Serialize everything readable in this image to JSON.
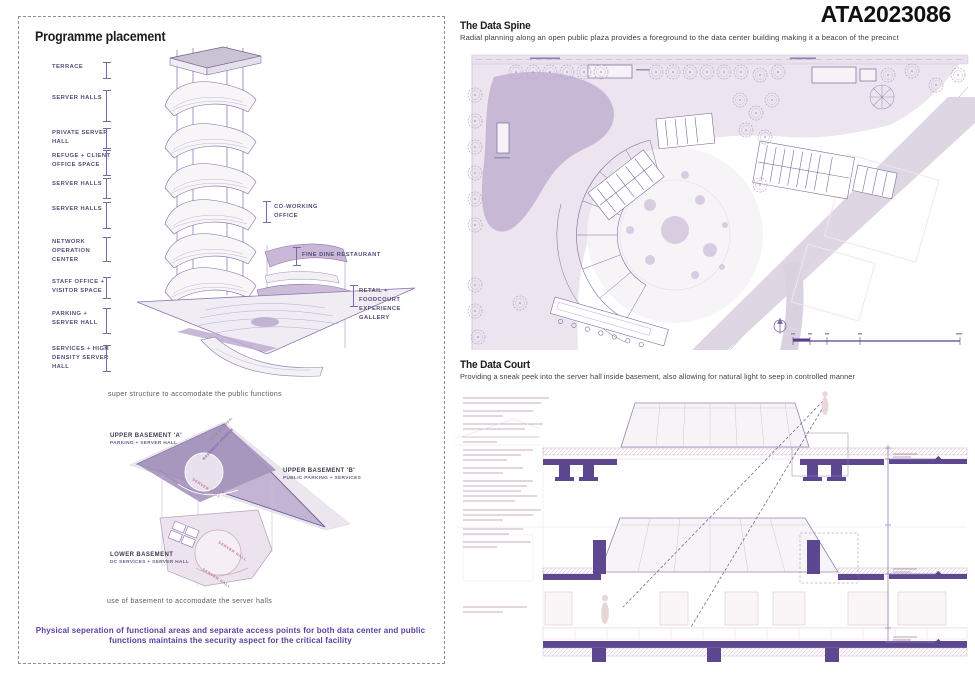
{
  "header": {
    "board_id": "ATA2023086"
  },
  "left_panel": {
    "title": "Programme placement",
    "programme_labels": [
      "TERRACE",
      "SERVER HALLS",
      "PRIVATE SERVER HALL",
      "REFUGE + CLIENT OFFICE SPACE",
      "SERVER HALLS",
      "SERVER HALLS",
      "NETWORK OPERATION CENTER",
      "STAFF OFFICE + VISITOR SPACE",
      "PARKING + SERVER HALL",
      "SERVICES + HIGH DENSITY SERVER HALL"
    ],
    "callouts": [
      "CO-WORKING OFFICE",
      "FINE DINE RESTAURANT",
      "RETAIL + FOODCOURT EXPERIENCE GALLERY"
    ],
    "tower_caption": "super structure to accomodate the public functions",
    "basement_labels": {
      "upper_a": "UPPER BASEMENT 'A'",
      "upper_a_sub": "PARKING + SERVER HALL",
      "upper_b": "UPPER BASEMENT 'B'",
      "upper_b_sub": "PUBLIC PARKING + SERVICES",
      "lower": "LOWER BASEMENT",
      "lower_sub": "DC SERVICES + SERVER HALL",
      "site_boundary": "SITE BOUNDARY",
      "basement_profile": "BASEMENT PROFILE",
      "server_hall": "SERVER HALL"
    },
    "basement_caption": "use of basement to accomodate the server halls",
    "summary": "Physical seperation of functional areas and separate access points for both data center and public functions maintains the security aspect for the critical facility"
  },
  "data_spine": {
    "title": "The Data Spine",
    "subtitle": "Radial planning along an open public plaza provides a foreground to the data center building making it a beacon of the precinct"
  },
  "data_court": {
    "title": "The Data Court",
    "subtitle": "Providing a sneak peek into the server hall inside basement, also allowing for natural light to seep in controlled manner",
    "section_label": "DATA COURT"
  },
  "colors": {
    "accent_purple": "#5b3f9e",
    "label_purple": "#534d78",
    "slab_purple": "#5c4790",
    "plan_lavender": "#ece5ef",
    "blob_purple": "#c7b9d5"
  }
}
